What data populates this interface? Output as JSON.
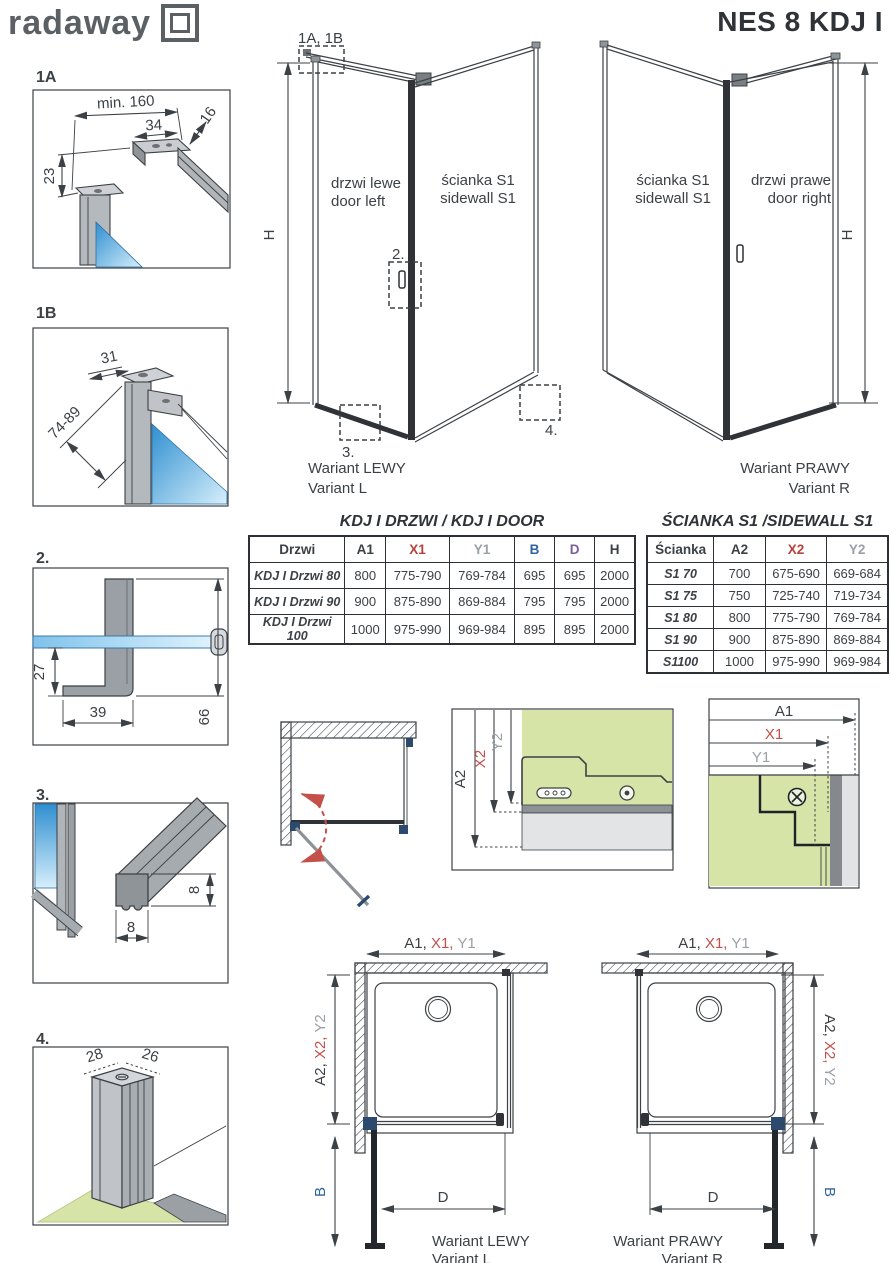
{
  "header": {
    "logo": "radaway",
    "title": "NES 8 KDJ I"
  },
  "details": {
    "d1a": {
      "label": "1A",
      "dim_min": "min. 160",
      "dim_a": "34",
      "dim_b": "16",
      "dim_c": "23"
    },
    "d1b": {
      "label": "1B",
      "dim_a": "31",
      "dim_b": "74-89"
    },
    "d2": {
      "label": "2.",
      "dim_a": "27",
      "dim_b": "39",
      "dim_c": "66"
    },
    "d3": {
      "label": "3.",
      "dim_a": "8",
      "dim_b": "8"
    },
    "d4": {
      "label": "4.",
      "dim_a": "28",
      "dim_b": "26"
    }
  },
  "views": {
    "left": {
      "callout_top": "1A, 1B",
      "callout_handle": "2.",
      "callout_bottom": "3.",
      "callout_wall": "4.",
      "height": "H",
      "door_l1": "drzwi lewe",
      "door_l2": "door left",
      "side_l1": "ścianka S1",
      "side_l2": "sidewall S1",
      "variant_l1": "Wariant LEWY",
      "variant_l2": "Variant L"
    },
    "right": {
      "height": "H",
      "side_l1": "ścianka S1",
      "side_l2": "sidewall S1",
      "door_l1": "drzwi prawe",
      "door_l2": "door right",
      "variant_l1": "Wariant PRAWY",
      "variant_l2": "Variant R"
    }
  },
  "door_table": {
    "title": "KDJ I DRZWI / KDJ I DOOR",
    "headers": [
      "Drzwi",
      "A1",
      "X1",
      "Y1",
      "B",
      "D",
      "H"
    ],
    "rows": [
      [
        "KDJ I Drzwi 80",
        "800",
        "775-790",
        "769-784",
        "695",
        "695",
        "2000"
      ],
      [
        "KDJ I Drzwi 90",
        "900",
        "875-890",
        "869-884",
        "795",
        "795",
        "2000"
      ],
      [
        "KDJ I Drzwi 100",
        "1000",
        "975-990",
        "969-984",
        "895",
        "895",
        "2000"
      ]
    ]
  },
  "sidewall_table": {
    "title": "ŚCIANKA S1 /SIDEWALL S1",
    "headers": [
      "Ścianka",
      "A2",
      "X2",
      "Y2"
    ],
    "rows": [
      [
        "S1 70",
        "700",
        "675-690",
        "669-684"
      ],
      [
        "S1 75",
        "750",
        "725-740",
        "719-734"
      ],
      [
        "S1 80",
        "800",
        "775-790",
        "769-784"
      ],
      [
        "S1 90",
        "900",
        "875-890",
        "869-884"
      ],
      [
        "S1100",
        "1000",
        "975-990",
        "969-984"
      ]
    ]
  },
  "sections": {
    "wall_mount": {
      "a2": "A2",
      "x2": "X2",
      "y2": "Y2"
    },
    "wall_corner": {
      "a1": "A1",
      "x1": "X1",
      "y1": "Y1"
    }
  },
  "plans": {
    "left": {
      "top_a1": "A1, ",
      "top_x1": "X1, ",
      "top_y1": "Y1",
      "side_a2": "A2, ",
      "side_x2": "X2, ",
      "side_y2": "Y2",
      "b": "B",
      "d": "D",
      "variant_l1": "Wariant LEWY",
      "variant_l2": "Variant L"
    },
    "right": {
      "top_a1": "A1, ",
      "top_x1": "X1, ",
      "top_y1": "Y1",
      "side_a2": "A2, ",
      "side_x2": "X2, ",
      "side_y2": "Y2",
      "b": "B",
      "d": "D",
      "variant_l1": "Wariant PRAWY",
      "variant_l2": "Variant R"
    }
  },
  "colors": {
    "red": "#c4504a",
    "gray": "#9aa0a6",
    "blue": "#30659c",
    "purple": "#7a5ea0",
    "dark": "#3c4145",
    "green": "#d7e4a8",
    "glass_blue": "#3f9ad6",
    "profile_gray": "#a6abb0"
  }
}
